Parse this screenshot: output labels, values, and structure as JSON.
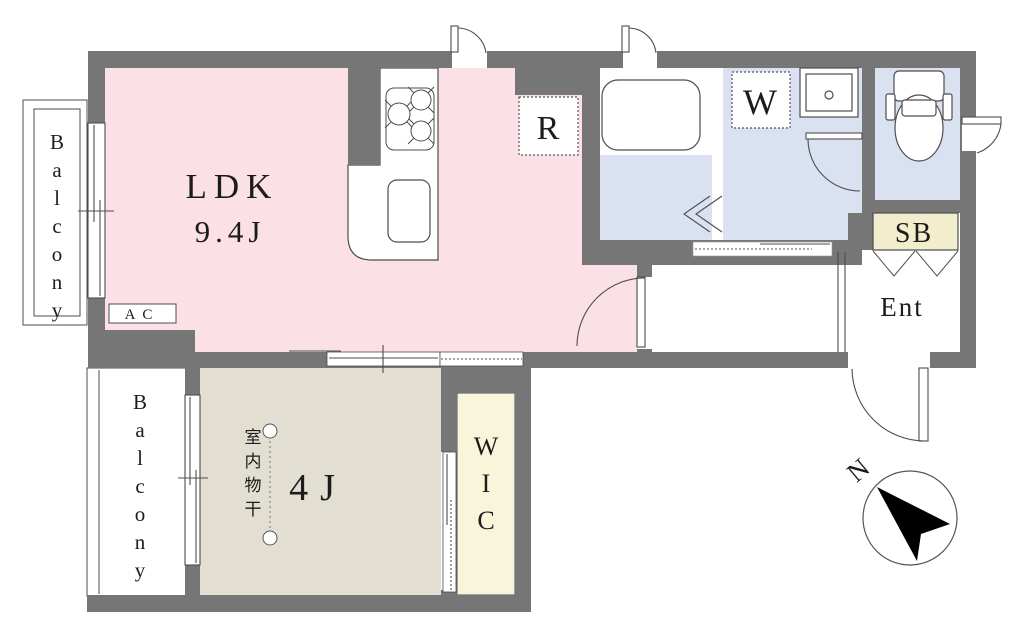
{
  "title": "apartment-floor-plan",
  "colors": {
    "wall": "#767676",
    "ldk": "#fbe1e5",
    "bedroom": "#e2ded2",
    "wet_area": "#dae2f1",
    "closet": "#f8f5da",
    "shoebox": "#f1edcd",
    "line": "#4d4d4d",
    "north_arrow": "#000000"
  },
  "labels": {
    "ldk": "LDK",
    "ldk_size": "9.4J",
    "bedroom": "4J",
    "wic": "WIC",
    "balcony_upper": "Balcony",
    "balcony_lower": "Balcony",
    "entrance": "Ent",
    "shoe_box": "SB",
    "refrigerator": "R",
    "washer": "W",
    "air_conditioner": "AC",
    "indoor_drying": "室内物干",
    "north": "N"
  }
}
